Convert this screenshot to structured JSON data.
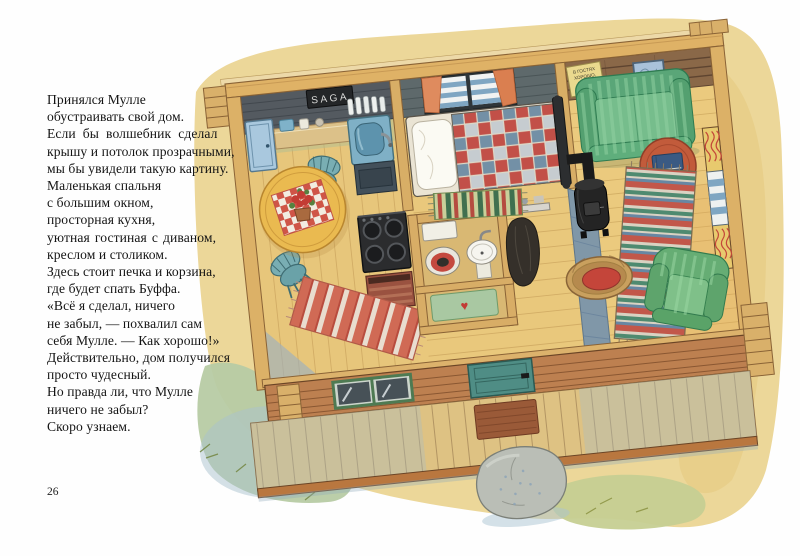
{
  "page": {
    "number": "26"
  },
  "story": {
    "lines": [
      "Принялся Мулле",
      "обустраивать свой дом.",
      "Если бы волшебник сделал",
      "крышу и потолок прозрачными,",
      "мы бы увидели такую картину.",
      "Маленькая спальня",
      "с большим окном,",
      "просторная кухня,",
      "уютная гостиная с диваном,",
      "креслом и столиком.",
      "Здесь стоит печка и корзина,",
      "где будет спать Буффа.",
      "«Всё я сделал, ничего",
      "не забыл, — похвалил сам",
      "себя Мулле. — Как хорошо!»",
      "Действительно, дом получился",
      "просто чудесный.",
      "Но правда ли, что Мулле",
      "ничего не забыл?",
      "Скоро узнаем."
    ]
  },
  "illustration": {
    "saga_sign": "SAGA",
    "wall_sign": {
      "line1": "В ГОСТЯХ",
      "line2": "ХОРОШО,",
      "line3": "А ДОМА",
      "line4": "ЛУЧШЕ!"
    },
    "bathmat_heart": "♥",
    "colors": {
      "wash": "#ecd799",
      "wood_floor": "#e9c87c",
      "beam": "#dfb266",
      "front_wall": "#bd8050",
      "sofa_green": "#5aa678",
      "armchair_green": "#66ad74",
      "quilt_red": "#c25048",
      "quilt_blue": "#7390a6",
      "door_teal": "#4f8d85",
      "rug_red": "#d06a55",
      "stove_black": "#222222",
      "table_yellow": "#eaba50",
      "side_table": "#c25b3b",
      "grass": "#b7cba4",
      "rock": "#b9bdb6"
    }
  }
}
